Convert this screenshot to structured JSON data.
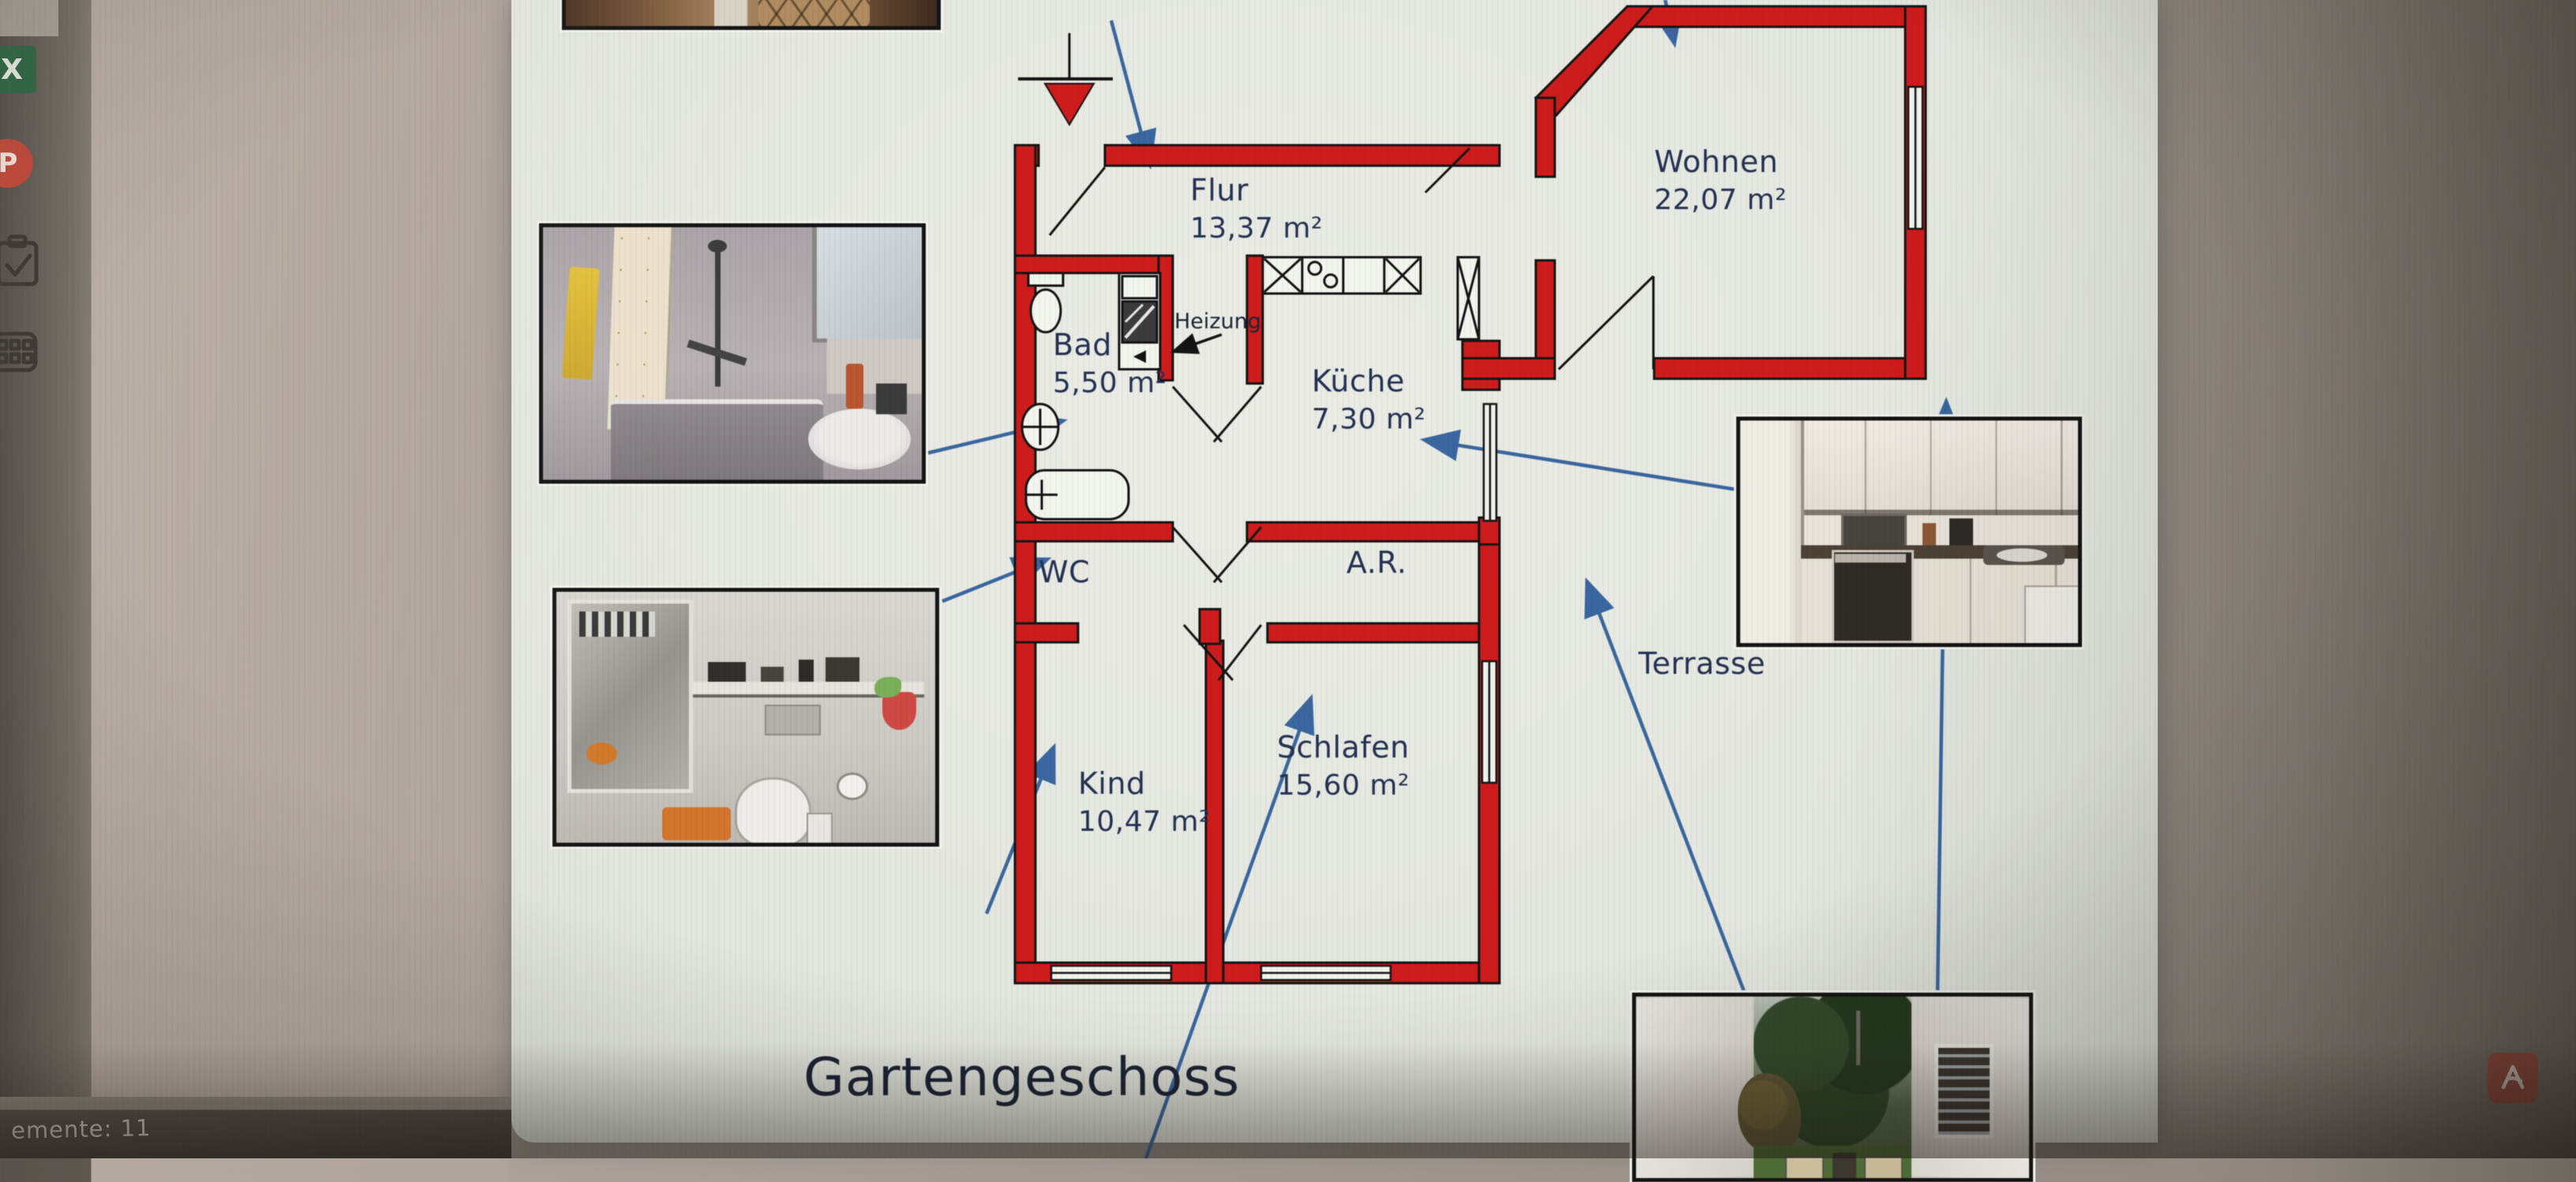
{
  "screen": {
    "status_text": "emente: 11",
    "dock_icons": [
      {
        "id": "excel-icon",
        "glyph": "X"
      },
      {
        "id": "presentation-icon",
        "glyph": "P"
      },
      {
        "id": "clipboard-check-icon",
        "glyph": ""
      },
      {
        "id": "dialpad-icon",
        "glyph": ""
      }
    ]
  },
  "plan": {
    "title": "Gartengeschoss",
    "heizung_label": "Heizung",
    "rooms": {
      "flur": {
        "name": "Flur",
        "area": "13,37 m²"
      },
      "wohnen": {
        "name": "Wohnen",
        "area": "22,07 m²"
      },
      "bad": {
        "name": "Bad",
        "area": "5,50 m²"
      },
      "kueche": {
        "name": "Küche",
        "area": "7,30 m²"
      },
      "wc": {
        "name": "WC",
        "area": ""
      },
      "ar": {
        "name": "A.R.",
        "area": ""
      },
      "kind": {
        "name": "Kind",
        "area": "10,47 m²"
      },
      "schlafen": {
        "name": "Schlafen",
        "area": "15,60 m²"
      },
      "terrasse": {
        "name": "Terrasse",
        "area": ""
      }
    },
    "colors": {
      "wall": "#ce1c1c",
      "label": "#243253",
      "arrow": "#3a679f"
    }
  }
}
